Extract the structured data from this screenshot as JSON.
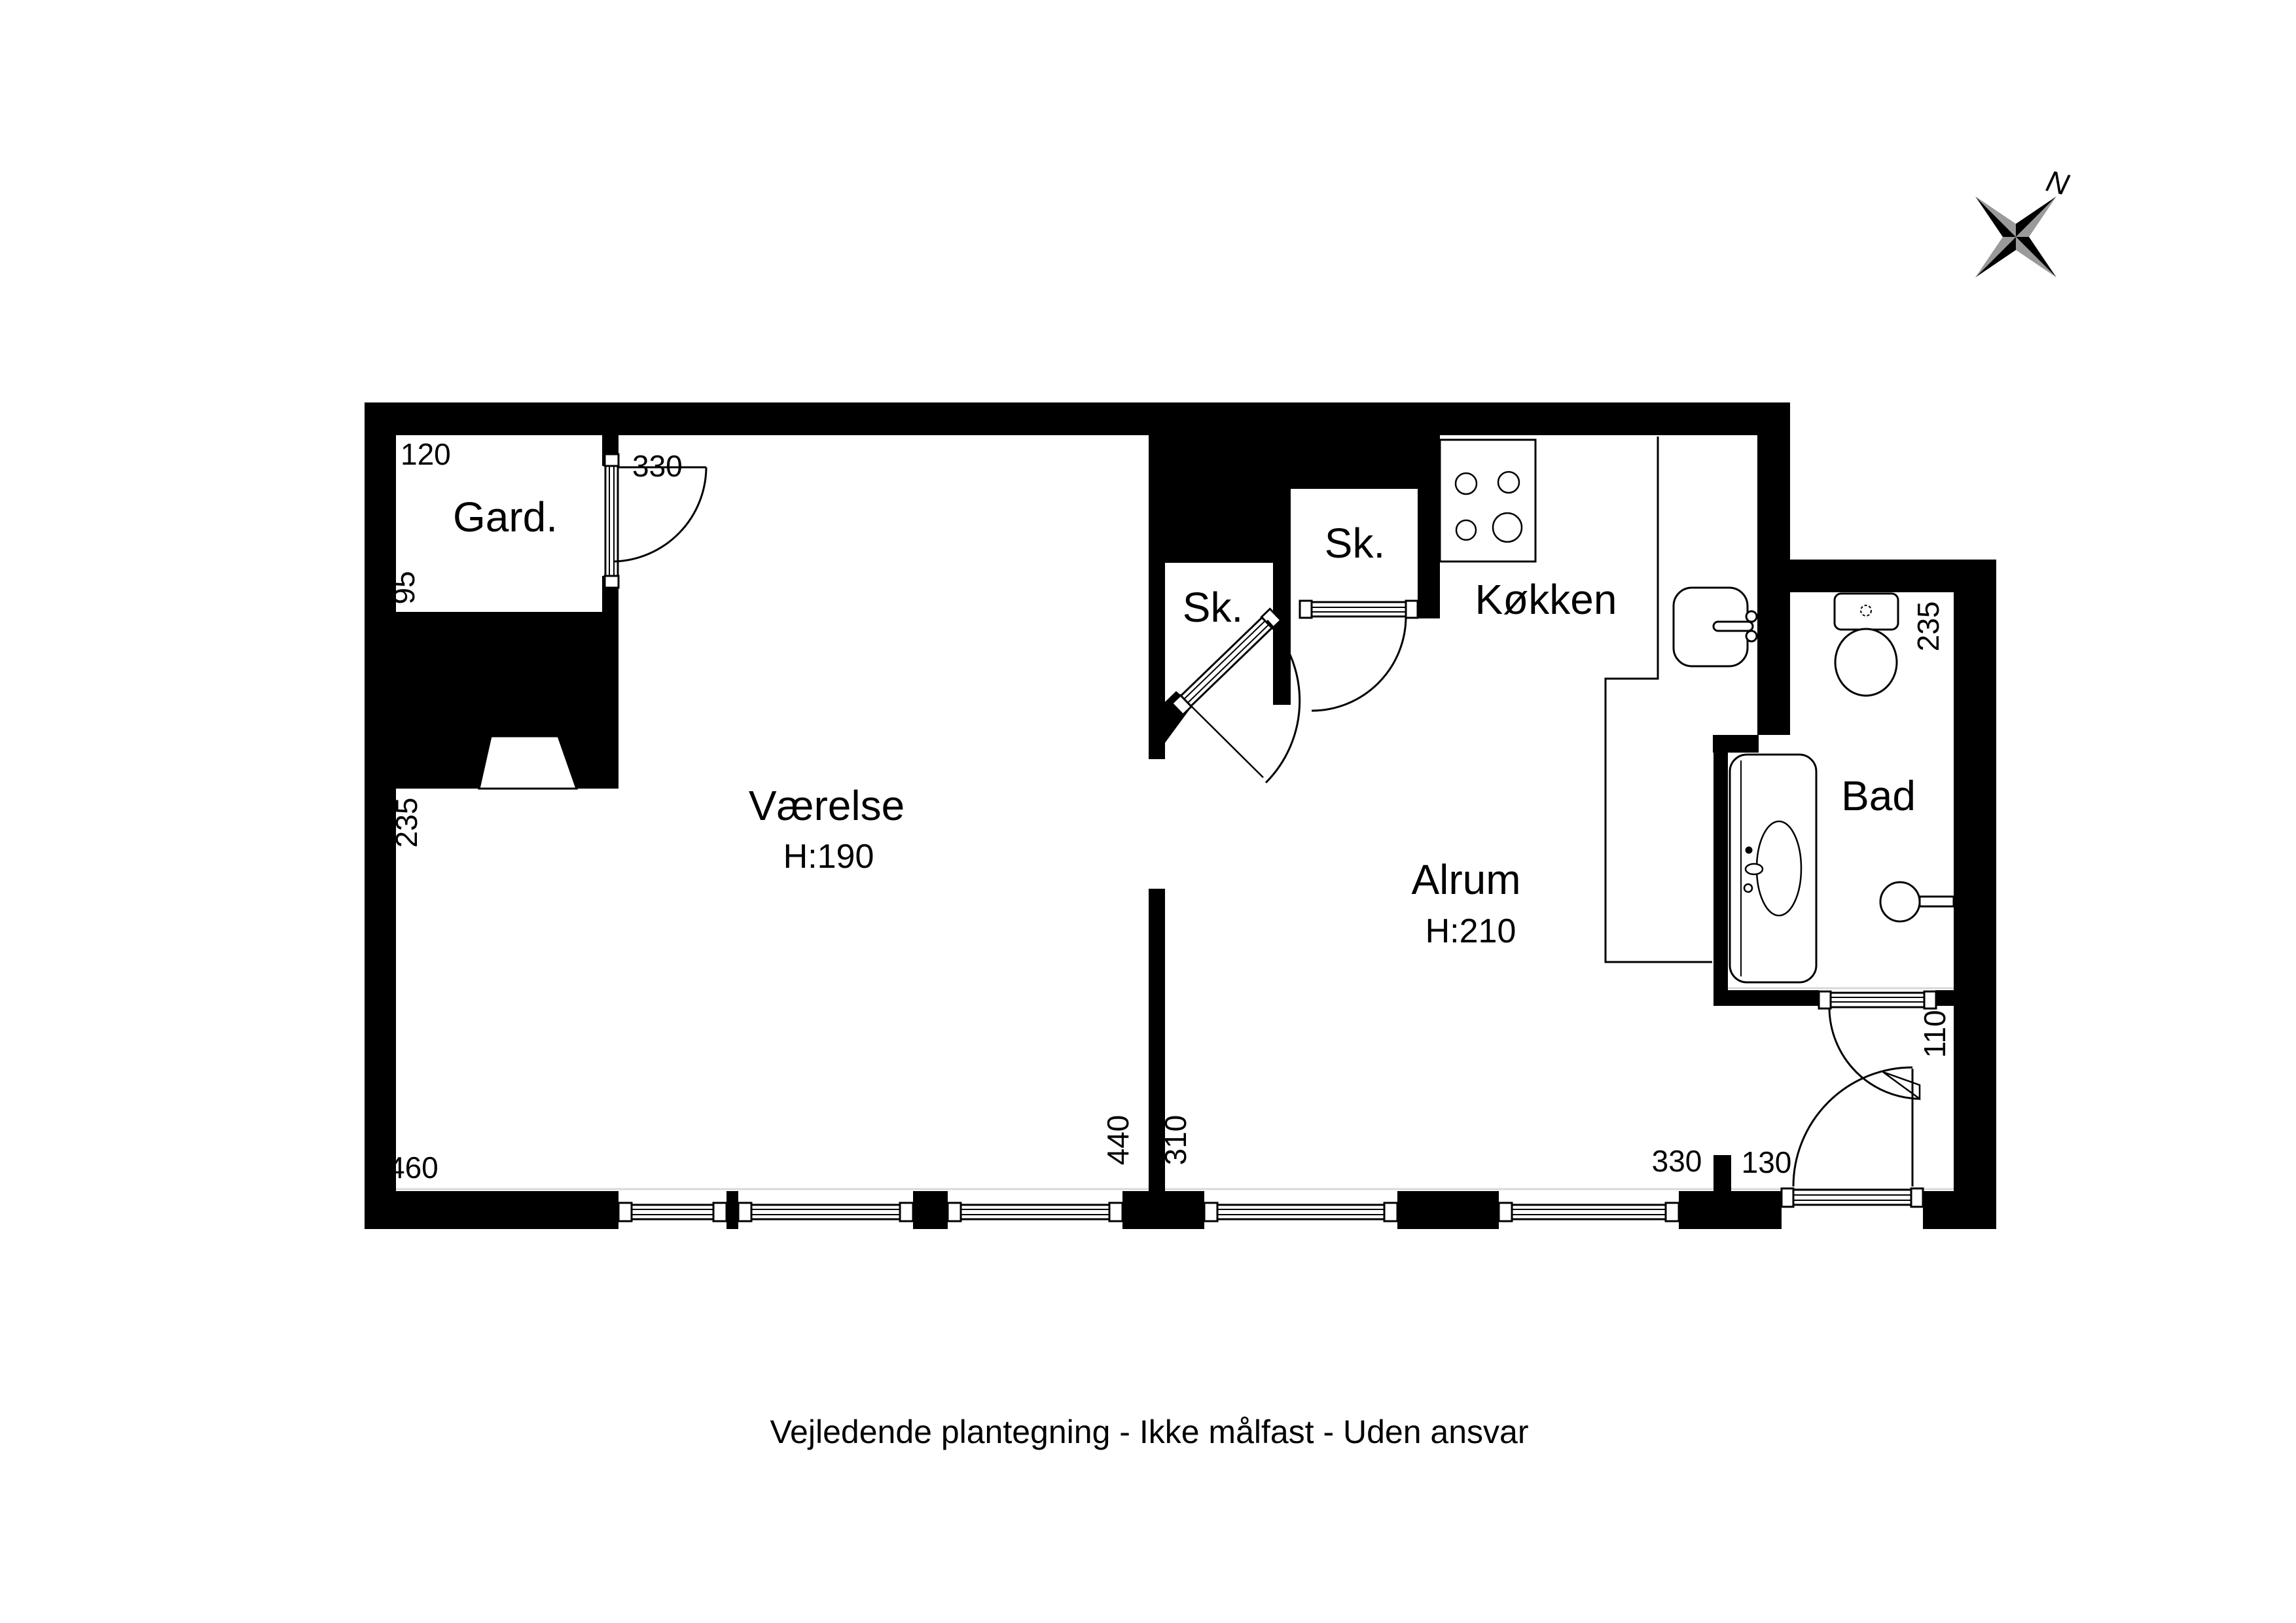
{
  "caption": "Vejledende plantegning - Ikke målfast - Uden ansvar",
  "compass": {
    "label": "N"
  },
  "colors": {
    "wall": "#000000",
    "background": "#ffffff",
    "compass_secondary": "#9a9a9a"
  },
  "rooms": {
    "gard": {
      "label": "Gard."
    },
    "vaerelse": {
      "label": "Værelse",
      "ceiling_height": "H:190"
    },
    "alrum": {
      "label": "Alrum",
      "ceiling_height": "H:210"
    },
    "koekken": {
      "label": "Køkken"
    },
    "bad": {
      "label": "Bad"
    },
    "sk_left": {
      "label": "Sk."
    },
    "sk_right": {
      "label": "Sk."
    }
  },
  "dimensions": {
    "gard_width": "120",
    "gard_depth": "95",
    "gard_door_span": "330",
    "vaerelse_left_wall": "235",
    "vaerelse_bottom": "460",
    "vaerelse_width": "440",
    "alrum_width": "310",
    "alrum_window_span": "330",
    "entrance_door_span": "130",
    "bad_door_span": "110",
    "bad_right_wall": "235"
  }
}
